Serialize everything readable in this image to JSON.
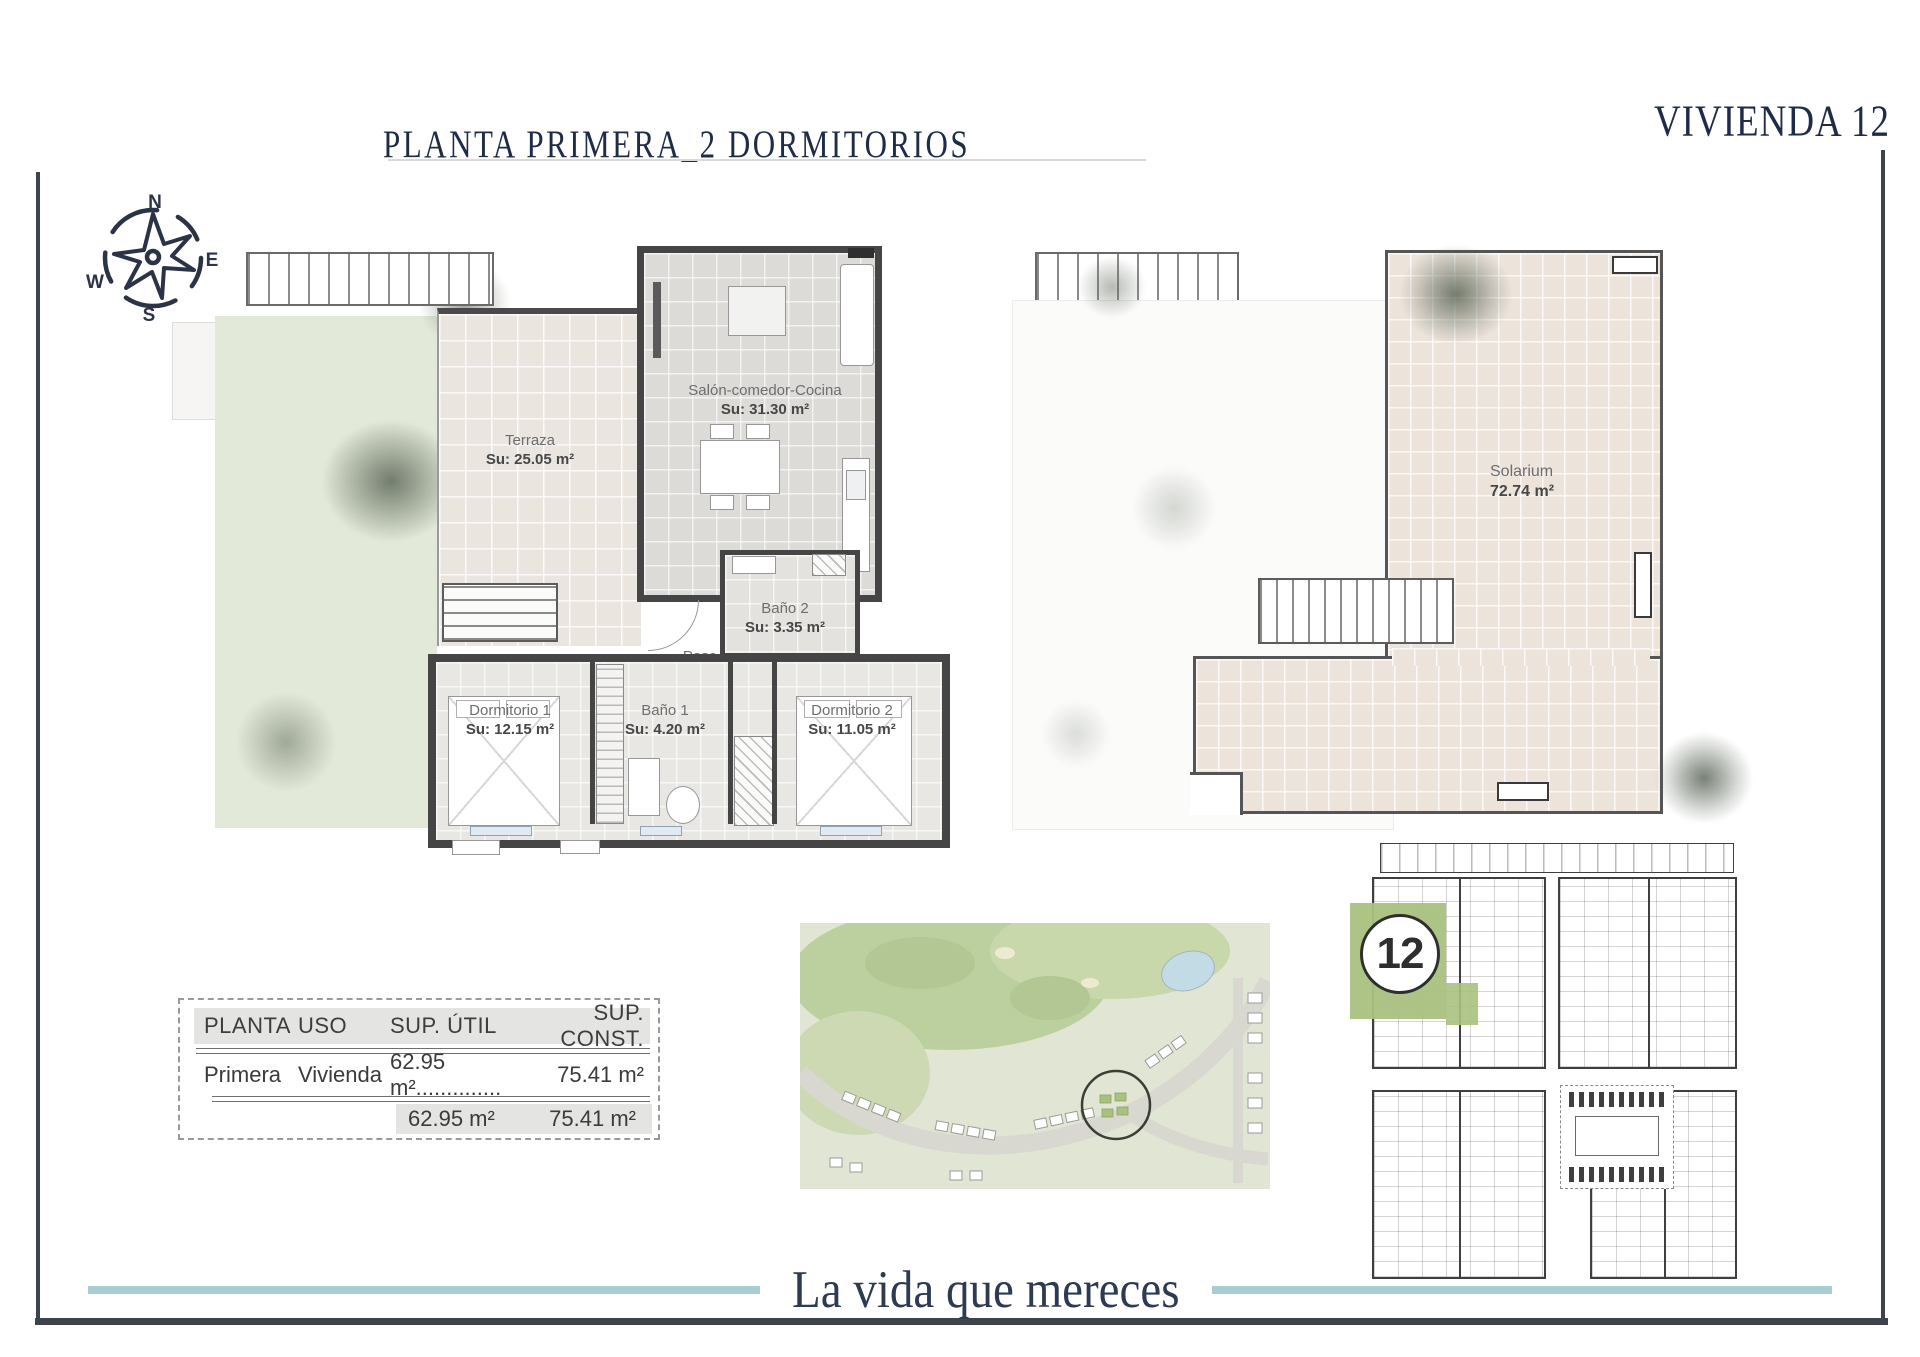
{
  "header": {
    "title": "PLANTA PRIMERA_2 DORMITORIOS",
    "vivienda": "VIVIENDA 12"
  },
  "compass": {
    "n": "N",
    "e": "E",
    "s": "S",
    "w": "W"
  },
  "plan_left": {
    "rooms": [
      {
        "name": "Terraza",
        "area": "Su: 25.05 m²"
      },
      {
        "name": "Salón-comedor-Cocina",
        "area": "Su: 31.30 m²"
      },
      {
        "name": "Baño 2",
        "area": "Su: 3.35 m²"
      },
      {
        "name": "Paso",
        "area": "Su: 0.90 m²"
      },
      {
        "name": "Dormitorio 1",
        "area": "Su: 12.15 m²"
      },
      {
        "name": "Baño 1",
        "area": "Su: 4.20 m²"
      },
      {
        "name": "Dormitorio 2",
        "area": "Su: 11.05 m²"
      }
    ]
  },
  "plan_right": {
    "room": {
      "name": "Solarium",
      "area": "72.74 m²"
    }
  },
  "areas_table": {
    "headers": [
      "PLANTA",
      "USO",
      "SUP. ÚTIL",
      "SUP. CONST."
    ],
    "row": {
      "planta": "Primera",
      "uso": "Vivienda",
      "sup_util": "62.95 m²..............",
      "sup_const": "75.41 m²"
    },
    "totals": {
      "sup_util": "62.95 m²",
      "sup_const": "75.41 m²"
    }
  },
  "key_plan": {
    "unit_number": "12"
  },
  "tagline": "La vida que mereces",
  "colors": {
    "navy": "#1e2c49",
    "frame_dark": "#3d444d",
    "teal_line": "#a9ced2",
    "highlight_green": "#a9c180"
  }
}
